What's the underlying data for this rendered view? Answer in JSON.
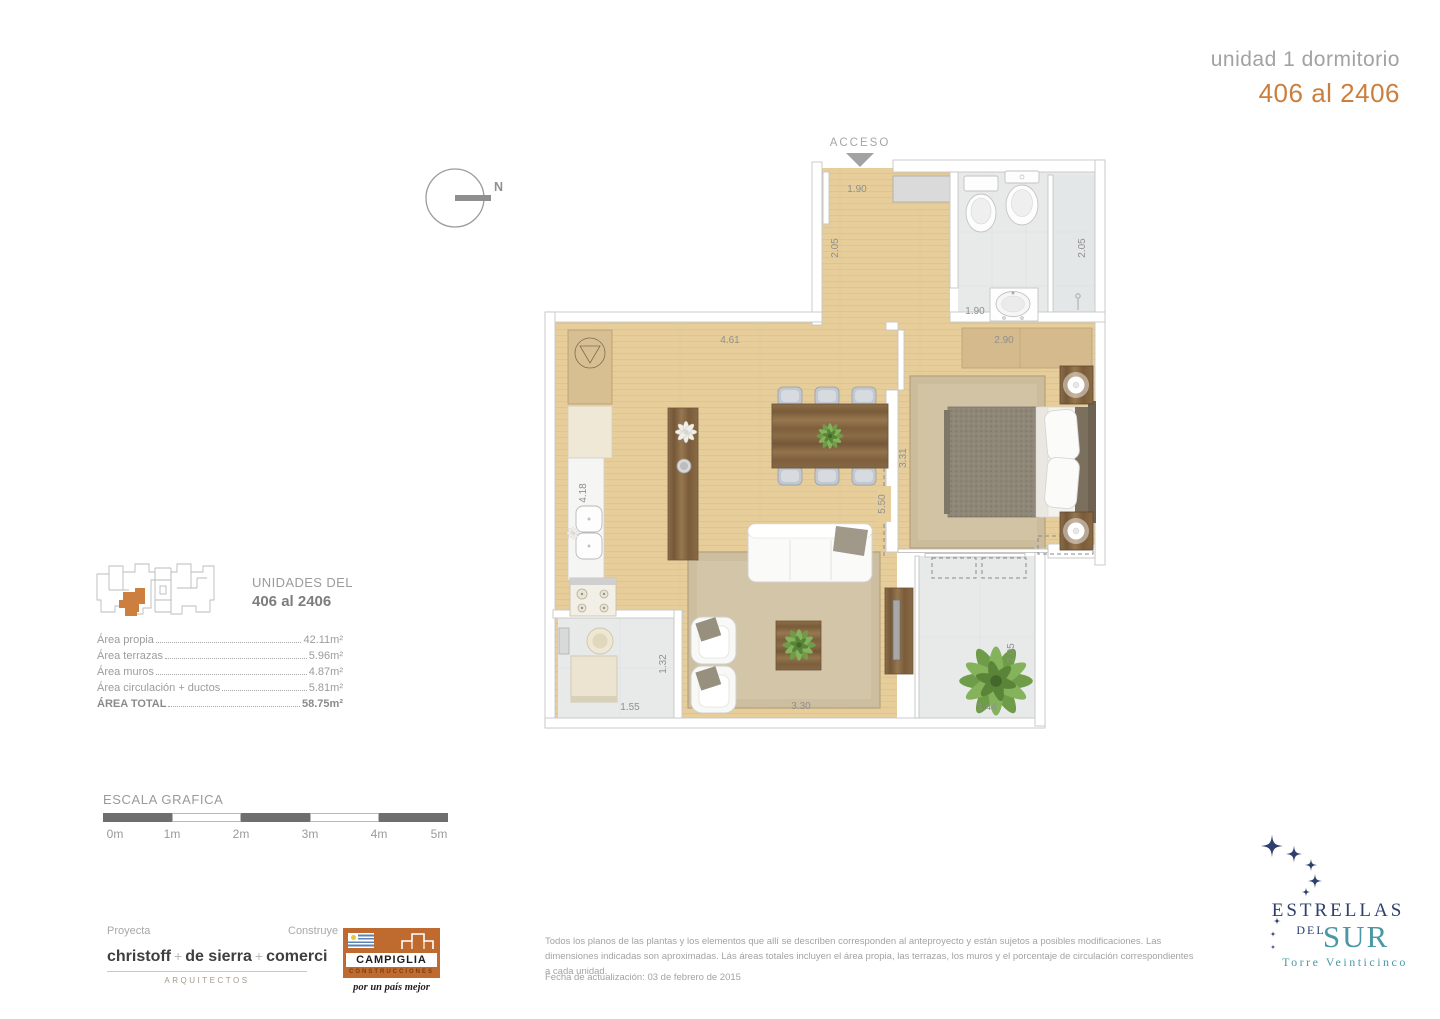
{
  "header": {
    "subtitle": "unidad 1 dormitorio",
    "title": "406 al 2406"
  },
  "plan": {
    "acceso_label": "ACCESO",
    "north_label": "N",
    "dimensions": {
      "entry_width": "1.90",
      "entry_depth": "2.05",
      "shower_depth": "2.05",
      "bath_width": "1.90",
      "bedroom_width": "2.90",
      "living_width": "4.61",
      "kitchen_depth": "4.18",
      "bedroom_depth": "3.31",
      "living_depth": "5.50",
      "laundry_width": "1.55",
      "laundry_depth": "1.32",
      "living_bottom_width": "3.30",
      "terrace_width": "1.44",
      "terrace_depth": "2.05"
    }
  },
  "unit_key": {
    "line1": "UNIDADES DEL",
    "line2": "406 al 2406"
  },
  "areas": {
    "rows": [
      {
        "label": "Área propia",
        "value": "42.11m²"
      },
      {
        "label": "Área terrazas",
        "value": "5.96m²"
      },
      {
        "label": "Área muros",
        "value": "4.87m²"
      },
      {
        "label": "Área circulación + ductos",
        "value": "5.81m²"
      },
      {
        "label": "ÁREA TOTAL",
        "value": "58.75m²"
      }
    ]
  },
  "scale": {
    "title": "ESCALA GRAFICA",
    "labels": [
      "0m",
      "1m",
      "2m",
      "3m",
      "4m",
      "5m"
    ]
  },
  "footer": {
    "proyecta_label": "Proyecta",
    "construye_label": "Construye",
    "architects": {
      "name_parts": [
        "christoff",
        "+",
        "de sierra",
        "+",
        "comerci"
      ],
      "subtitle": "ARQUITECTOS"
    },
    "builder": {
      "name": "CAMPIGLIA",
      "subtitle": "CONSTRUCCIONES",
      "tagline": "por un país mejor"
    },
    "disclaimer": "Todos los planos de las plantas y los elementos que allí se describen corresponden al anteproyecto y están sujetos a posibles modificaciones. Las dimensiones indicadas son aproximadas. Lás áreas totales incluyen el área propia, las terrazas, los muros y el porcentaje de circulación correspondientes a cada unidad.",
    "update_date": "Fecha de actualización: 03 de febrero de 2015"
  },
  "brand": {
    "line1": "ESTRELLAS",
    "line2": "DEL",
    "line3": "SUR",
    "line4": "Torre Veinticinco"
  },
  "colors": {
    "accent_orange": "#cb7f3e",
    "title_gray": "#a2a2a2",
    "navy": "#2e3f6e",
    "teal": "#4a98a6",
    "campiglia_orange": "#bf6a2e",
    "wood_floor": "#e6cd99",
    "tile_gray": "#e8eaea"
  }
}
